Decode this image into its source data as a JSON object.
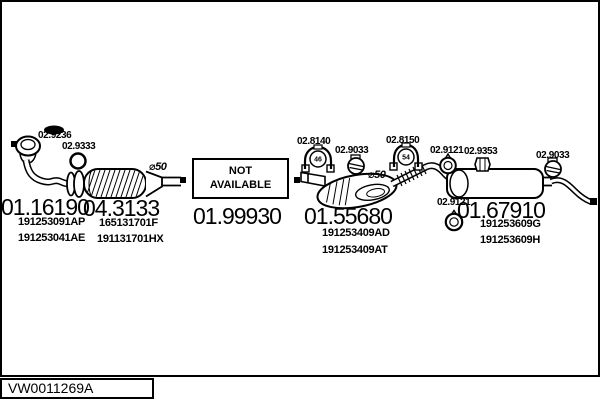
{
  "page": {
    "background": "#ffffff",
    "ink": "#000000"
  },
  "footer": {
    "drawing_code": "VW0011269A"
  },
  "diagram": {
    "front_pipe": {
      "part_number": "01.16190",
      "oe_numbers": [
        "191253091AP",
        "191253041AE"
      ],
      "gasket_label": "02.9236",
      "seal_ring_label": "02.9333"
    },
    "catalytic_converter": {
      "part_number": "04.3133",
      "oe_numbers": [
        "165131701F",
        "191131701HX"
      ],
      "pipe_diameter": "⌀50"
    },
    "centre_section": {
      "part_number": "01.99930",
      "status_line1": "NOT",
      "status_line2": "AVAILABLE"
    },
    "middle_silencer": {
      "part_number": "01.55680",
      "oe_numbers": [
        "191253409AD",
        "191253409AT"
      ],
      "clamp_label": "02.8140",
      "clamp_size": "46",
      "bracket_clamp_label": "02.9033",
      "pipe_diameter": "⌀50"
    },
    "rear_silencer": {
      "part_number": "01.67910",
      "oe_numbers": [
        "191253609G",
        "191253609H"
      ],
      "clamp_label": "02.8150",
      "clamp_size": "54",
      "hanger_front_label": "02.9121",
      "rubber_mount_label": "02.9353",
      "tail_clamp_label": "02.9033",
      "hanger_rear_label": "02.9121"
    }
  }
}
